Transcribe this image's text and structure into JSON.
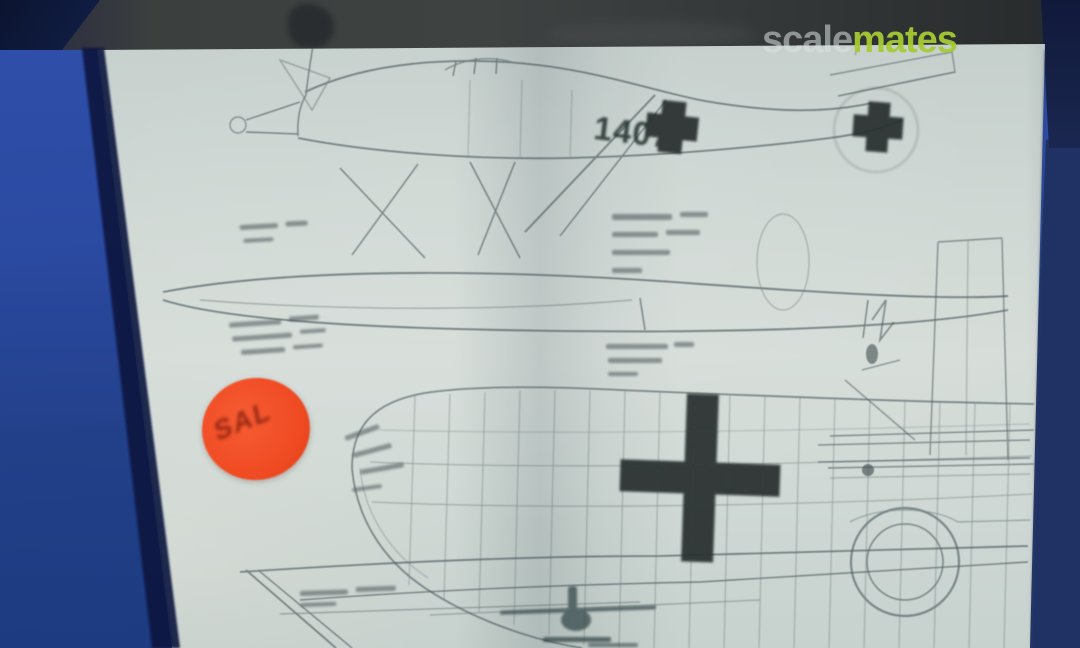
{
  "watermark": {
    "scale": "scale",
    "mates": "mates"
  },
  "plan": {
    "fuselage_code": "1407",
    "sticker_label": "SAL",
    "markings": [
      "balkenkreuz-cross-fuselage",
      "balkenkreuz-cross-tail",
      "balkenkreuz-cross-wing"
    ]
  },
  "colors": {
    "background_left_blue": "#2b4aa2",
    "background_right_blue": "#223567",
    "top_band": "#3b3f3e",
    "paper": "#cdd6d2",
    "drawing_ink": "#49585c",
    "marking_ink": "#1d2627",
    "sticker_orange": "#ef4a22",
    "watermark_green": "#a6cb33"
  }
}
